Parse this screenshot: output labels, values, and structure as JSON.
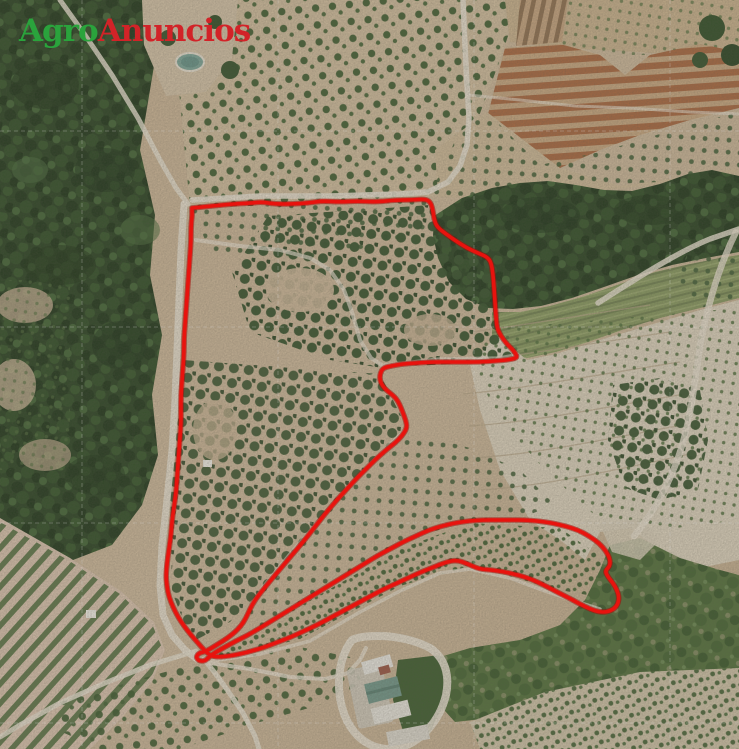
{
  "page": {
    "title": "Aerial plot photo with boundary overlay",
    "width": 739,
    "height": 749
  },
  "brand": {
    "word_green": "Agro",
    "word_red": "Anuncios",
    "green_color": "#2aa33c",
    "red_color": "#d22328"
  },
  "map": {
    "kind": "aerial-orthophoto",
    "overlay": {
      "boundary_color": "#e8130e",
      "boundary_casing_color": "#a50e0a",
      "boundary_stroke_width": 3.6,
      "boundary_points": [
        [
          192,
          208
        ],
        [
          212,
          206
        ],
        [
          232,
          204
        ],
        [
          252,
          203
        ],
        [
          262,
          202
        ],
        [
          275,
          204
        ],
        [
          292,
          204
        ],
        [
          308,
          203
        ],
        [
          322,
          201
        ],
        [
          340,
          202
        ],
        [
          358,
          201
        ],
        [
          376,
          202
        ],
        [
          396,
          200
        ],
        [
          412,
          200
        ],
        [
          426,
          199
        ],
        [
          431,
          203
        ],
        [
          433,
          211
        ],
        [
          434,
          219
        ],
        [
          437,
          227
        ],
        [
          446,
          234
        ],
        [
          456,
          241
        ],
        [
          467,
          248
        ],
        [
          478,
          253
        ],
        [
          487,
          257
        ],
        [
          491,
          262
        ],
        [
          493,
          274
        ],
        [
          494,
          288
        ],
        [
          495,
          302
        ],
        [
          496,
          316
        ],
        [
          497,
          328
        ],
        [
          501,
          336
        ],
        [
          506,
          343
        ],
        [
          512,
          349
        ],
        [
          516,
          354
        ],
        [
          517,
          358
        ],
        [
          507,
          360
        ],
        [
          494,
          361
        ],
        [
          480,
          362
        ],
        [
          464,
          362
        ],
        [
          448,
          362
        ],
        [
          432,
          362
        ],
        [
          416,
          363
        ],
        [
          402,
          364
        ],
        [
          391,
          366
        ],
        [
          383,
          368
        ],
        [
          380,
          374
        ],
        [
          380,
          381
        ],
        [
          384,
          388
        ],
        [
          390,
          393
        ],
        [
          396,
          398
        ],
        [
          400,
          405
        ],
        [
          403,
          413
        ],
        [
          406,
          421
        ],
        [
          407,
          428
        ],
        [
          402,
          436
        ],
        [
          395,
          443
        ],
        [
          386,
          450
        ],
        [
          376,
          459
        ],
        [
          366,
          469
        ],
        [
          356,
          479
        ],
        [
          346,
          490
        ],
        [
          336,
          501
        ],
        [
          325,
          514
        ],
        [
          314,
          528
        ],
        [
          303,
          542
        ],
        [
          292,
          555
        ],
        [
          281,
          568
        ],
        [
          271,
          580
        ],
        [
          262,
          591
        ],
        [
          255,
          600
        ],
        [
          250,
          609
        ],
        [
          246,
          618
        ],
        [
          241,
          626
        ],
        [
          234,
          633
        ],
        [
          226,
          639
        ],
        [
          218,
          644
        ],
        [
          210,
          649
        ],
        [
          204,
          652
        ],
        [
          199,
          653
        ],
        [
          196,
          657
        ],
        [
          199,
          661
        ],
        [
          205,
          661
        ],
        [
          209,
          657
        ],
        [
          216,
          652
        ],
        [
          225,
          647
        ],
        [
          236,
          641
        ],
        [
          248,
          635
        ],
        [
          260,
          628
        ],
        [
          273,
          620
        ],
        [
          286,
          612
        ],
        [
          299,
          604
        ],
        [
          312,
          596
        ],
        [
          325,
          588
        ],
        [
          338,
          580
        ],
        [
          351,
          572
        ],
        [
          364,
          564
        ],
        [
          377,
          556
        ],
        [
          390,
          549
        ],
        [
          403,
          542
        ],
        [
          416,
          536
        ],
        [
          429,
          530
        ],
        [
          442,
          526
        ],
        [
          455,
          523
        ],
        [
          468,
          521
        ],
        [
          482,
          520
        ],
        [
          496,
          520
        ],
        [
          510,
          520
        ],
        [
          524,
          520
        ],
        [
          538,
          521
        ],
        [
          552,
          523
        ],
        [
          565,
          526
        ],
        [
          578,
          530
        ],
        [
          589,
          536
        ],
        [
          599,
          543
        ],
        [
          606,
          551
        ],
        [
          610,
          559
        ],
        [
          610,
          566
        ],
        [
          605,
          571
        ],
        [
          608,
          577
        ],
        [
          613,
          583
        ],
        [
          617,
          590
        ],
        [
          619,
          597
        ],
        [
          618,
          604
        ],
        [
          614,
          609
        ],
        [
          607,
          612
        ],
        [
          599,
          612
        ],
        [
          590,
          609
        ],
        [
          580,
          604
        ],
        [
          569,
          598
        ],
        [
          557,
          592
        ],
        [
          544,
          585
        ],
        [
          531,
          579
        ],
        [
          518,
          575
        ],
        [
          505,
          572
        ],
        [
          492,
          570
        ],
        [
          479,
          569
        ],
        [
          468,
          564
        ],
        [
          457,
          560
        ],
        [
          446,
          562
        ],
        [
          434,
          567
        ],
        [
          421,
          572
        ],
        [
          408,
          578
        ],
        [
          395,
          584
        ],
        [
          382,
          590
        ],
        [
          369,
          597
        ],
        [
          356,
          604
        ],
        [
          343,
          611
        ],
        [
          330,
          618
        ],
        [
          317,
          625
        ],
        [
          304,
          631
        ],
        [
          291,
          637
        ],
        [
          278,
          642
        ],
        [
          265,
          647
        ],
        [
          252,
          651
        ],
        [
          240,
          654
        ],
        [
          229,
          656
        ],
        [
          219,
          657
        ],
        [
          211,
          656
        ],
        [
          205,
          651
        ],
        [
          198,
          643
        ],
        [
          191,
          635
        ],
        [
          184,
          626
        ],
        [
          178,
          617
        ],
        [
          173,
          607
        ],
        [
          169,
          597
        ],
        [
          167,
          587
        ],
        [
          166,
          576
        ],
        [
          167,
          563
        ],
        [
          169,
          549
        ],
        [
          171,
          535
        ],
        [
          172,
          521
        ],
        [
          174,
          507
        ],
        [
          176,
          493
        ],
        [
          177,
          479
        ],
        [
          178,
          465
        ],
        [
          179,
          451
        ],
        [
          180,
          437
        ],
        [
          181,
          423
        ],
        [
          181,
          409
        ],
        [
          181,
          395
        ],
        [
          182,
          381
        ],
        [
          183,
          367
        ],
        [
          184,
          353
        ],
        [
          184,
          339
        ],
        [
          185,
          325
        ],
        [
          186,
          311
        ],
        [
          187,
          297
        ],
        [
          188,
          283
        ],
        [
          189,
          269
        ],
        [
          190,
          255
        ],
        [
          191,
          241
        ],
        [
          191,
          227
        ],
        [
          192,
          216
        ]
      ]
    },
    "graticule": {
      "color": "#ffffff",
      "vertical_x": [
        82,
        278,
        474,
        670
      ],
      "horizontal_y": [
        131,
        327,
        523,
        723
      ]
    },
    "terrain_features": [
      "pine-forest-west",
      "orchards-north",
      "ploughed-terrace-stripes-northeast",
      "pine-forest-band-east",
      "green-terrace-strip-east",
      "pale-terraced-slope-east",
      "dense-orchard-inside-plot",
      "vineyard-rows-southwest",
      "scrub-hillside-southeast",
      "farm-buildings-south",
      "irrigation-pond",
      "dirt-roads"
    ]
  }
}
